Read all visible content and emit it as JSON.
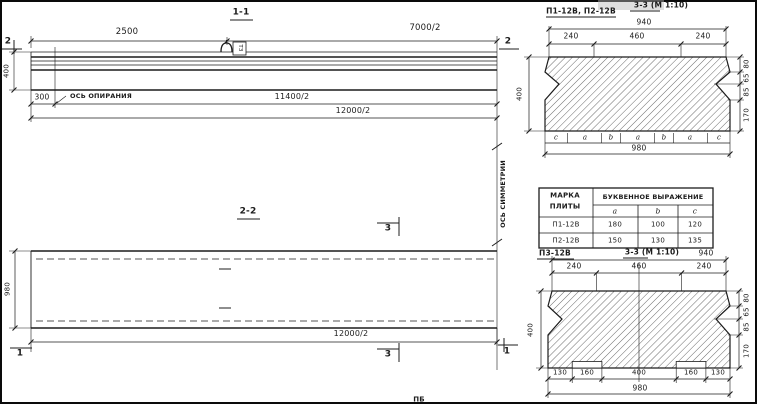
{
  "section_1_1": {
    "title": "1-1",
    "cut_mark_left": "2",
    "cut_mark_right": "2",
    "dim_2500": "2500",
    "dim_7000": "7000/2",
    "dim_400": "400",
    "dim_300": "300",
    "support_axis_label": "ОСЬ ОПИРАНИЯ",
    "hook_tag": "ТЗ",
    "dim_11400": "11400/2",
    "dim_12000": "12000/2"
  },
  "section_2_2": {
    "title": "2-2",
    "dim_980": "980",
    "dim_12000": "12000/2",
    "cut_mark_3_top": "3",
    "cut_mark_3_bottom": "3",
    "cut_mark_1_left": "1",
    "cut_mark_1_right": "1"
  },
  "symmetry_axis_label": "ОСЬ СИММЕТРИИ",
  "section_3_3_top": {
    "label": "П1-12В, П2-12В",
    "title": "3-3 (М 1:10)",
    "dim_940": "940",
    "dims_top": [
      "240",
      "460",
      "240"
    ],
    "dim_400": "400",
    "dims_right": [
      "80",
      "65",
      "85",
      "170"
    ],
    "letters": [
      "c",
      "a",
      "b",
      "a",
      "b",
      "a",
      "c"
    ],
    "dim_980": "980"
  },
  "table": {
    "header_mark_line1": "МАРКА",
    "header_mark_line2": "ПЛИТЫ",
    "header_expr": "БУКВЕННОЕ  ВЫРАЖЕНИЕ",
    "cols": [
      "a",
      "b",
      "c"
    ],
    "rows": [
      {
        "mark": "П1-12В",
        "a": "180",
        "b": "100",
        "c": "120"
      },
      {
        "mark": "П2-12В",
        "a": "150",
        "b": "130",
        "c": "135"
      }
    ]
  },
  "section_3_3_bottom": {
    "label": "П3-12В",
    "title": "3-3 (М 1:10)",
    "dim_940": "940",
    "dims_top": [
      "240",
      "460",
      "240"
    ],
    "dim_400": "400",
    "dims_right": [
      "80",
      "65",
      "85",
      "170"
    ],
    "dims_bottom": [
      "130",
      "160",
      "400",
      "160",
      "130"
    ],
    "dim_980": "980"
  },
  "bottom_note": "ПБ"
}
